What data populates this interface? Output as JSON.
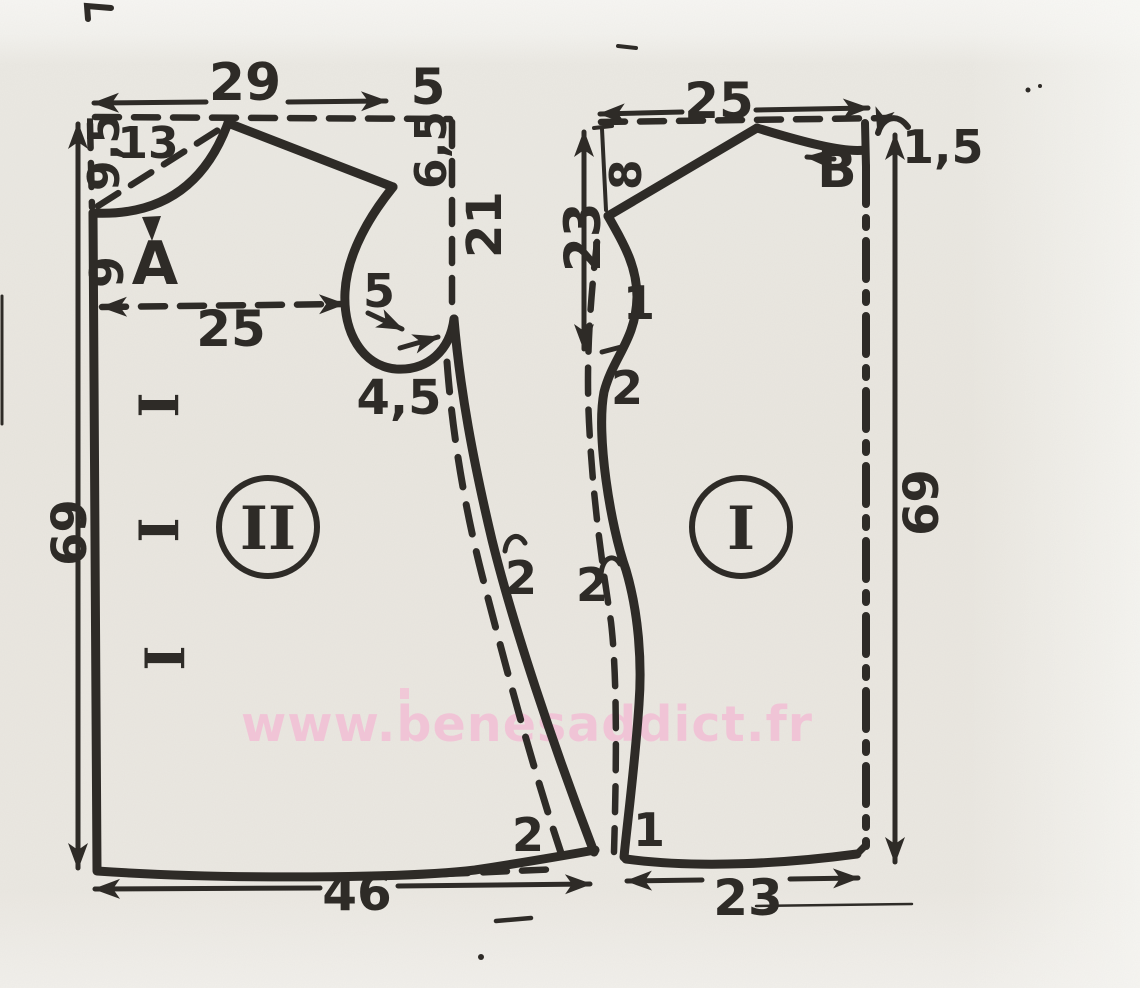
{
  "watermark": {
    "text": "www.benesaddict.fr",
    "color": "#f2c0d5"
  },
  "colors": {
    "ink": "#2e2b27",
    "paper": "#eae7e0"
  },
  "pieces": {
    "back": {
      "label": "II",
      "top_width": "29",
      "shoulder_extra": "5",
      "neck_depth": "9,5",
      "neck_diagonal": "13",
      "point_a": "A",
      "center_offset": "9",
      "half_width": "25",
      "armhole_top": "6,5",
      "armhole_depth": "21",
      "armhole_notch": "5",
      "armhole_base": "4,5",
      "length": "69",
      "hem_width": "46",
      "hem_rise": "2",
      "side_offset": "2",
      "button_mark": "I"
    },
    "front": {
      "label": "I",
      "top_width": "25",
      "neck_drop": "1,5",
      "point_b": "B",
      "shoulder_drop": "8",
      "edge_depth": "23",
      "notch_one": "1",
      "edge_offset_upper": "2",
      "edge_offset_lower": "2",
      "length": "69",
      "hem_width": "23",
      "hem_notch": "1"
    }
  }
}
